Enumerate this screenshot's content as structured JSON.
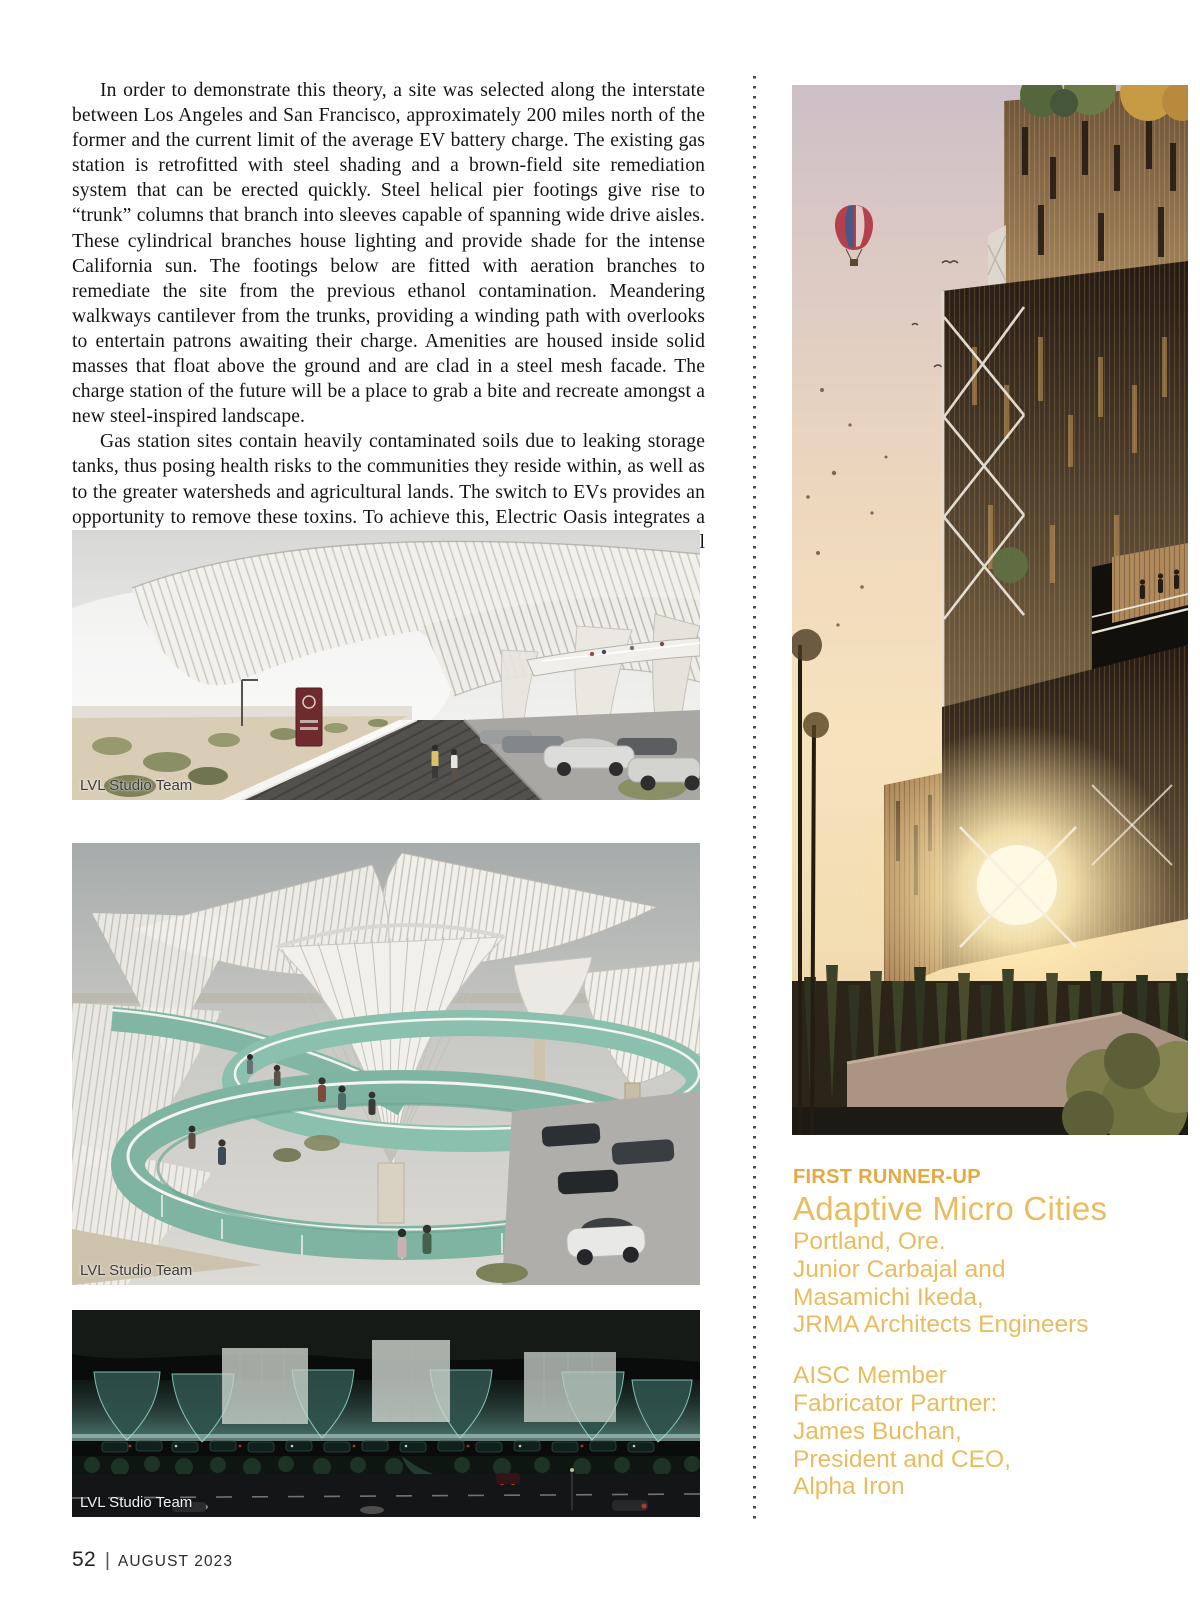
{
  "article": {
    "paragraphs": [
      "In order to demonstrate this theory, a site was selected along the interstate between Los Angeles and San Francisco, approximately 200 miles north of the former and the current limit of the average EV battery charge. The existing gas station is retrofitted with steel shading and a brown-field site remediation system that can be erected quickly. Steel helical pier footings give rise to “trunk” columns that branch into sleeves capable of spanning wide drive aisles. These cylindrical branches house lighting and provide shade for the intense California sun. The footings below are fitted with aeration branches to remediate the site from the previous ethanol contamination. Meandering walkways cantilever from the trunks, providing a winding path with overlooks to entertain patrons awaiting their charge. Amenities are housed inside solid masses that float above the ground and are clad in a steel mesh facade. The charge station of the future will be a place to grab a bite and recreate amongst a new steel-inspired landscape.",
      "Gas station sites contain heavily contaminated soils due to leaking storage tanks, thus posing health risks to the communities they reside within, as well as to the greater watersheds and agricultural lands. The switch to EVs provides an opportunity to remove these toxins. To achieve this, Electric Oasis integrates a bio-remediating aeration system into the footings of the long-spanning steel shade structures."
    ]
  },
  "figures": [
    {
      "caption": "LVL Studio Team",
      "alt": "Daytime rendering of EV charge station with sweeping white ribbed steel canopies over drive aisles"
    },
    {
      "caption": "LVL Studio Team",
      "alt": "Close-up rendering of trumpet-shaped canopy columns with a green spiral walkway and visitors"
    },
    {
      "caption": "LVL Studio Team",
      "alt": "Night aerial rendering of the charge station glowing teal beside a highway"
    }
  ],
  "hero": {
    "alt": "Sunset rendering of Adaptive Micro Cities, a tall timber-slat tower with rooftop trees and a hot air balloon in the sky"
  },
  "award": {
    "label": "FIRST RUNNER-UP",
    "title": "Adaptive Micro Cities",
    "location": "Portland, Ore.",
    "designers": [
      "Junior Carbajal and",
      "Masamichi Ikeda,",
      "JRMA Architects Engineers"
    ],
    "partner": [
      "AISC Member",
      "Fabricator Partner:",
      "James Buchan,",
      "President and CEO,",
      "Alpha Iron"
    ]
  },
  "footer": {
    "page_number": "52",
    "separator": "|",
    "issue": "AUGUST 2023"
  },
  "colors": {
    "accent_gold_bold": "#E5A943",
    "accent_gold_light": "#EABC5F",
    "divider_dot": "#4B4B4B",
    "body_text": "#141414"
  }
}
